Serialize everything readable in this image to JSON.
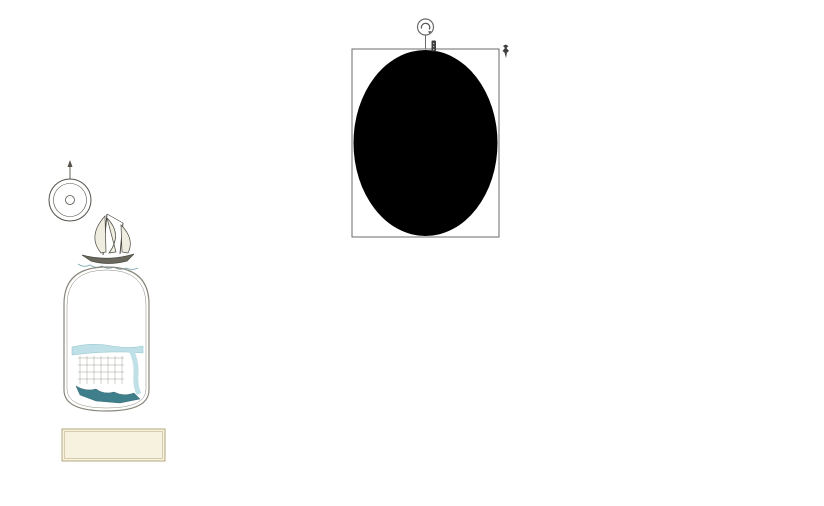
{
  "annotation": {
    "tool_name": "ellipse-highlight",
    "fill": "#2e6287",
    "opacity": 0.72,
    "bbox": {
      "x": 352,
      "y": 49,
      "w": 147,
      "h": 188
    },
    "ellipse": {
      "cx": 425.5,
      "cy": 143,
      "rx": 72,
      "ry": 93
    },
    "rotation_handle": {
      "cx": 425.5,
      "cy": 27,
      "r": 8
    },
    "handles": [
      "tl",
      "tc",
      "tr",
      "ml",
      "mr",
      "bl",
      "bc",
      "br"
    ]
  },
  "map": {
    "colors": {
      "paper": "#fffdf6",
      "water": "#cbe6ec",
      "water_line": "#8fc3cf",
      "sand": "#e8ddc0",
      "sand_line": "#c4b48c",
      "lot_yellow": "#efe48a",
      "lot_line": "#a49e6e",
      "lot_inner": "#fffef8",
      "tree": "#a4d463",
      "tree_line": "#6b9c39",
      "road_casing": "#908d80",
      "pink": "#dd7777",
      "pink_fill": "#fdeeee",
      "green_strip": "#a8d767",
      "green_strip_line": "#6fa03c",
      "pier": "#8f8a33",
      "label_dark": "#2f2f2f",
      "label_teal": "#23505c",
      "label_blue": "#39628c",
      "street_text": "#8b8578"
    },
    "labels": [
      {
        "text": "To the Atlantic Ocean",
        "x": 745,
        "y": 21,
        "fs": 11,
        "color": "#2f2f2f",
        "ls": 1
      },
      {
        "text": "Pretty  Lake",
        "x": 98,
        "y": 481,
        "fs": 11,
        "color": "#23505c",
        "ls": 3
      },
      {
        "text": "Pretty Lake Marinas",
        "x": 642,
        "y": 496,
        "fs": 11,
        "color": "#2f2f2f",
        "ls": 1
      },
      {
        "text": "Bay Front Green",
        "x": 738,
        "y": 78,
        "fs": 4.5,
        "color": "#2e5d2e",
        "rot": -90,
        "ls": 0
      }
    ],
    "street_labels": [
      {
        "text": "E A S T   B E A C H   D R I V E",
        "x": 322,
        "y": 87,
        "fs": 6
      },
      {
        "text": "E A S T   B E A C H   D R I V E",
        "x": 668,
        "y": 98,
        "fs": 5.5
      },
      {
        "text": "P L E A S A N T    A V E N U E",
        "x": 553,
        "y": 234,
        "fs": 6.5
      },
      {
        "text": "HAMMOCK  LANE",
        "x": 452,
        "y": 340,
        "fs": 5.5
      },
      {
        "text": "HAMMOCK  LANE",
        "x": 630,
        "y": 352,
        "fs": 5.5
      }
    ],
    "curved_labels": [
      {
        "path": "pth-shore",
        "text": "S H O R E   D R I V E",
        "fs": 6.5,
        "offset": "6%"
      },
      {
        "path": "pth-pla",
        "text": "P R E T T Y   L A K E   A V E N U E",
        "fs": 6.5,
        "offset": "8%"
      }
    ],
    "boxes": [
      {
        "x": 434,
        "y": 56,
        "w": 44,
        "h": 34,
        "stroke": "#dd6b6b",
        "sw": 1.5,
        "fill": "#fdf3f3",
        "lines": [
          "Bay Front",
          "Club Tower",
          "Pool, Fitness"
        ],
        "fs": 5,
        "tcolor": "#2c5d8a"
      },
      {
        "x": 578,
        "y": 210,
        "w": 46,
        "h": 26,
        "stroke": "#e06a6a",
        "sw": 2,
        "fill": "#ffffff",
        "lines": [
          "Fountain",
          "Park"
        ],
        "fs": 6,
        "tcolor": "#2f2f2f"
      },
      {
        "x": 583,
        "y": 303,
        "w": 44,
        "h": 40,
        "stroke": "#e06a6a",
        "sw": 2,
        "fill": "#ffffff",
        "lines": [
          "Tennis",
          "Courts"
        ],
        "fs": 5.5,
        "tcolor": "#2f2f2f"
      },
      {
        "x": 627,
        "y": 303,
        "w": 48,
        "h": 40,
        "stroke": "#e06a6a",
        "sw": 2,
        "fill": "#ffffff",
        "lines": [
          "Stage Pavilion",
          "Playground"
        ],
        "fs": 5.2,
        "tcolor": "#2f2f2f"
      },
      {
        "x": 586,
        "y": 366,
        "w": 40,
        "h": 28,
        "stroke": "#e06a6a",
        "sw": 2,
        "fill": "#ffffff",
        "lines": [
          "Garden",
          "Pergola"
        ],
        "fs": 5.5,
        "tcolor": "#2f2f2f"
      },
      {
        "x": 383,
        "y": 410,
        "w": 92,
        "h": 26,
        "stroke": "#e89b9b",
        "sw": 2,
        "fill": "#fffef4",
        "lines": [
          "East Beach Villas"
        ],
        "fs": 6.5,
        "tcolor": "#39628c"
      },
      {
        "x": 700,
        "y": 186,
        "w": 80,
        "h": 48,
        "stroke": "#97948a",
        "sw": 1,
        "fill": "#fffdf4",
        "inner": true,
        "lines": [
          "Pleasant",
          "Village",
          "Apartments"
        ],
        "fs": 5,
        "tcolor": "#39628c"
      }
    ],
    "green_strips": [
      {
        "x": 88,
        "y": 34,
        "w": 24,
        "h": 48
      },
      {
        "x": 141,
        "y": 38,
        "w": 11,
        "h": 44
      },
      {
        "x": 255,
        "y": 42,
        "w": 13,
        "h": 44
      },
      {
        "x": 413,
        "y": 58,
        "w": 15,
        "h": 36
      },
      {
        "x": 666,
        "y": 56,
        "w": 20,
        "h": 40
      },
      {
        "x": 729,
        "y": 56,
        "w": 18,
        "h": 40
      },
      {
        "x": 576,
        "y": 96,
        "w": 17,
        "h": 48
      }
    ],
    "top_columns": [
      {
        "x": 63,
        "y": 33,
        "w": 25,
        "h": 50,
        "rows": 7,
        "cols": 1
      },
      {
        "x": 112,
        "y": 33,
        "w": 25,
        "h": 50,
        "rows": 7,
        "cols": 1
      },
      {
        "x": 152,
        "y": 36,
        "w": 25,
        "h": 46,
        "rows": 7,
        "cols": 1
      },
      {
        "x": 196,
        "y": 46,
        "w": 52,
        "h": 42,
        "rows": 3,
        "cols": 2
      },
      {
        "x": 272,
        "y": 46,
        "w": 50,
        "h": 42,
        "rows": 3,
        "cols": 2
      },
      {
        "x": 326,
        "y": 48,
        "w": 48,
        "h": 40,
        "rows": 3,
        "cols": 2
      },
      {
        "x": 378,
        "y": 48,
        "w": 32,
        "h": 40,
        "rows": 3,
        "cols": 1
      },
      {
        "x": 482,
        "y": 52,
        "w": 46,
        "h": 44,
        "rows": 4,
        "cols": 2
      },
      {
        "x": 532,
        "y": 52,
        "w": 21,
        "h": 44,
        "rows": 4,
        "cols": 1
      },
      {
        "x": 556,
        "y": 52,
        "w": 21,
        "h": 44,
        "rows": 4,
        "cols": 1
      },
      {
        "x": 580,
        "y": 53,
        "w": 21,
        "h": 44,
        "rows": 4,
        "cols": 1
      },
      {
        "x": 604,
        "y": 53,
        "w": 21,
        "h": 44,
        "rows": 4,
        "cols": 1
      },
      {
        "x": 628,
        "y": 54,
        "w": 21,
        "h": 44,
        "rows": 4,
        "cols": 1
      },
      {
        "x": 644,
        "y": 54,
        "w": 18,
        "h": 42,
        "rows": 4,
        "cols": 1
      },
      {
        "x": 690,
        "y": 55,
        "w": 21,
        "h": 42,
        "rows": 4,
        "cols": 1
      },
      {
        "x": 712,
        "y": 55,
        "w": 15,
        "h": 42,
        "rows": 4,
        "cols": 1
      },
      {
        "x": 751,
        "y": 56,
        "w": 20,
        "h": 42,
        "rows": 4,
        "cols": 1
      },
      {
        "x": 774,
        "y": 56,
        "w": 20,
        "h": 42,
        "rows": 4,
        "cols": 1
      }
    ],
    "blocks": [
      {
        "x": 256,
        "y": 98,
        "w": 38,
        "h": 130,
        "rows": 9,
        "cols": 2
      },
      {
        "x": 304,
        "y": 98,
        "w": 37,
        "h": 130,
        "rows": 9,
        "cols": 2
      },
      {
        "x": 351,
        "y": 99,
        "w": 37,
        "h": 129,
        "rows": 9,
        "cols": 2
      },
      {
        "x": 398,
        "y": 99,
        "w": 37,
        "h": 129,
        "rows": 9,
        "cols": 2
      },
      {
        "x": 445,
        "y": 100,
        "w": 37,
        "h": 128,
        "rows": 9,
        "cols": 2
      },
      {
        "x": 492,
        "y": 100,
        "w": 38,
        "h": 128,
        "rows": 9,
        "cols": 2
      },
      {
        "x": 540,
        "y": 101,
        "w": 37,
        "h": 127,
        "rows": 9,
        "cols": 2
      },
      {
        "x": 587,
        "y": 101,
        "w": 38,
        "h": 103,
        "rows": 7,
        "cols": 2
      },
      {
        "x": 635,
        "y": 102,
        "w": 37,
        "h": 126,
        "rows": 9,
        "cols": 2
      },
      {
        "x": 682,
        "y": 103,
        "w": 38,
        "h": 80,
        "rows": 6,
        "cols": 2
      },
      {
        "x": 730,
        "y": 104,
        "w": 37,
        "h": 78,
        "rows": 6,
        "cols": 2
      },
      {
        "x": 777,
        "y": 105,
        "w": 30,
        "h": 122,
        "rows": 9,
        "cols": 2
      },
      {
        "x": 256,
        "y": 246,
        "w": 38,
        "h": 88,
        "rows": 6,
        "cols": 2
      },
      {
        "x": 304,
        "y": 246,
        "w": 37,
        "h": 88,
        "rows": 6,
        "cols": 2
      },
      {
        "x": 351,
        "y": 246,
        "w": 37,
        "h": 88,
        "rows": 6,
        "cols": 2
      },
      {
        "x": 398,
        "y": 246,
        "w": 37,
        "h": 88,
        "rows": 6,
        "cols": 2
      },
      {
        "x": 445,
        "y": 247,
        "w": 37,
        "h": 87,
        "rows": 6,
        "cols": 2
      },
      {
        "x": 492,
        "y": 247,
        "w": 38,
        "h": 87,
        "rows": 6,
        "cols": 2
      },
      {
        "x": 540,
        "y": 248,
        "w": 37,
        "h": 86,
        "rows": 6,
        "cols": 2
      },
      {
        "x": 587,
        "y": 248,
        "w": 38,
        "h": 50,
        "rows": 3,
        "cols": 2
      },
      {
        "x": 635,
        "y": 249,
        "w": 37,
        "h": 85,
        "rows": 6,
        "cols": 2
      },
      {
        "x": 682,
        "y": 250,
        "w": 38,
        "h": 86,
        "rows": 6,
        "cols": 2
      },
      {
        "x": 730,
        "y": 251,
        "w": 37,
        "h": 86,
        "rows": 6,
        "cols": 2
      },
      {
        "x": 777,
        "y": 252,
        "w": 30,
        "h": 86,
        "rows": 6,
        "cols": 2
      },
      {
        "x": 256,
        "y": 352,
        "w": 38,
        "h": 60,
        "rows": 4,
        "cols": 2
      },
      {
        "x": 304,
        "y": 352,
        "w": 37,
        "h": 60,
        "rows": 4,
        "cols": 2
      },
      {
        "x": 351,
        "y": 352,
        "w": 37,
        "h": 52,
        "rows": 4,
        "cols": 2
      },
      {
        "x": 398,
        "y": 352,
        "w": 37,
        "h": 52,
        "rows": 4,
        "cols": 2
      },
      {
        "x": 445,
        "y": 353,
        "w": 37,
        "h": 52,
        "rows": 4,
        "cols": 2
      },
      {
        "x": 492,
        "y": 353,
        "w": 38,
        "h": 68,
        "rows": 5,
        "cols": 2
      },
      {
        "x": 540,
        "y": 354,
        "w": 37,
        "h": 66,
        "rows": 5,
        "cols": 2
      },
      {
        "x": 587,
        "y": 354,
        "w": 38,
        "h": 62,
        "rows": 4,
        "cols": 2
      },
      {
        "x": 635,
        "y": 360,
        "w": 37,
        "h": 58,
        "rows": 4,
        "cols": 2
      },
      {
        "x": 682,
        "y": 360,
        "w": 38,
        "h": 58,
        "rows": 4,
        "cols": 2
      },
      {
        "x": 730,
        "y": 362,
        "w": 37,
        "h": 56,
        "rows": 4,
        "cols": 2
      },
      {
        "x": 777,
        "y": 362,
        "w": 30,
        "h": 56,
        "rows": 4,
        "cols": 2
      },
      {
        "x": 587,
        "y": 422,
        "w": 38,
        "h": 34,
        "rows": 2,
        "cols": 2
      },
      {
        "x": 635,
        "y": 424,
        "w": 37,
        "h": 32,
        "rows": 2,
        "cols": 2
      },
      {
        "x": 682,
        "y": 426,
        "w": 38,
        "h": 32,
        "rows": 2,
        "cols": 2
      },
      {
        "x": 730,
        "y": 428,
        "w": 37,
        "h": 30,
        "rows": 2,
        "cols": 2
      },
      {
        "x": 777,
        "y": 428,
        "w": 30,
        "h": 28,
        "rows": 2,
        "cols": 2
      }
    ],
    "buildings": [
      {
        "x": 204,
        "y": 266,
        "w": 36,
        "h": 18,
        "r": -3
      },
      {
        "x": 248,
        "y": 262,
        "w": 28,
        "h": 14,
        "r": -2
      },
      {
        "x": 206,
        "y": 312,
        "w": 30,
        "h": 22,
        "r": -2
      },
      {
        "x": 244,
        "y": 310,
        "w": 24,
        "h": 16,
        "r": 0
      },
      {
        "x": 298,
        "y": 308,
        "w": 26,
        "h": 14,
        "r": 0
      },
      {
        "x": 212,
        "y": 360,
        "w": 30,
        "h": 16,
        "r": 0
      },
      {
        "x": 252,
        "y": 358,
        "w": 22,
        "h": 12,
        "r": 0
      },
      {
        "x": 286,
        "y": 356,
        "w": 30,
        "h": 14,
        "r": 0
      },
      {
        "x": 224,
        "y": 404,
        "w": 40,
        "h": 14,
        "r": 2
      },
      {
        "x": 282,
        "y": 402,
        "w": 26,
        "h": 12,
        "r": 1
      },
      {
        "x": 112,
        "y": 96,
        "w": 12,
        "h": 36,
        "r": 0
      }
    ],
    "streets_v": [
      {
        "x": 232,
        "y1": 90,
        "y2": 422
      },
      {
        "x": 252,
        "y1": 90,
        "y2": 424
      },
      {
        "x": 300,
        "y1": 90,
        "y2": 428
      },
      {
        "x": 347,
        "y1": 91,
        "y2": 430
      },
      {
        "x": 394,
        "y1": 91,
        "y2": 434
      },
      {
        "x": 441,
        "y1": 92,
        "y2": 438
      },
      {
        "x": 488,
        "y1": 93,
        "y2": 442
      },
      {
        "x": 536,
        "y1": 94,
        "y2": 446
      },
      {
        "x": 583,
        "y1": 95,
        "y2": 450
      },
      {
        "x": 631,
        "y1": 96,
        "y2": 452
      },
      {
        "x": 678,
        "y1": 97,
        "y2": 456
      },
      {
        "x": 726,
        "y1": 98,
        "y2": 460
      },
      {
        "x": 773,
        "y1": 99,
        "y2": 462
      }
    ],
    "tree_rows": [
      {
        "x": 252,
        "y": 104,
        "dx": 0,
        "dy": 27,
        "n": 12
      },
      {
        "x": 300,
        "y": 104,
        "dx": 0,
        "dy": 27,
        "n": 12
      },
      {
        "x": 347,
        "y": 106,
        "dx": 0,
        "dy": 27,
        "n": 12
      },
      {
        "x": 394,
        "y": 106,
        "dx": 0,
        "dy": 27,
        "n": 12
      },
      {
        "x": 441,
        "y": 106,
        "dx": 0,
        "dy": 27,
        "n": 12
      },
      {
        "x": 488,
        "y": 108,
        "dx": 0,
        "dy": 27,
        "n": 12
      },
      {
        "x": 536,
        "y": 108,
        "dx": 0,
        "dy": 27,
        "n": 12
      },
      {
        "x": 583,
        "y": 108,
        "dx": 0,
        "dy": 27,
        "n": 12
      },
      {
        "x": 631,
        "y": 110,
        "dx": 0,
        "dy": 27,
        "n": 12
      },
      {
        "x": 678,
        "y": 110,
        "dx": 0,
        "dy": 27,
        "n": 12
      },
      {
        "x": 726,
        "y": 112,
        "dx": 0,
        "dy": 27,
        "n": 12
      },
      {
        "x": 773,
        "y": 112,
        "dx": 0,
        "dy": 27,
        "n": 12
      },
      {
        "x": 262,
        "y": 244,
        "dx": 31,
        "dy": 0,
        "n": 17
      },
      {
        "x": 348,
        "y": 351,
        "dx": 31,
        "dy": 0.3,
        "n": 16
      },
      {
        "x": 246,
        "y": 430,
        "dx": 31,
        "dy": 1.2,
        "n": 11
      },
      {
        "x": 584,
        "y": 452,
        "dx": 30,
        "dy": 1.4,
        "n": 8
      },
      {
        "x": 242,
        "y": 97,
        "dx": 33,
        "dy": 0.35,
        "n": 18
      },
      {
        "x": 150,
        "y": 128,
        "dx": 13,
        "dy": 37,
        "n": 5
      },
      {
        "x": 208,
        "y": 318,
        "dx": 6,
        "dy": 36,
        "n": 3
      },
      {
        "x": 206,
        "y": 240,
        "dx": 44,
        "dy": 0,
        "n": 4
      },
      {
        "x": 210,
        "y": 420,
        "dx": 40,
        "dy": 1,
        "n": 4
      },
      {
        "x": 371,
        "y": 118,
        "dx": 2,
        "dy": 24,
        "n": 4
      },
      {
        "x": 433,
        "y": 146,
        "dx": 8,
        "dy": 22,
        "n": 3
      },
      {
        "x": 54,
        "y": 94,
        "dx": 58,
        "dy": -2,
        "n": 2
      },
      {
        "x": 64,
        "y": 138,
        "dx": 50,
        "dy": -2,
        "n": 2
      }
    ],
    "logo": {
      "title1": "EAST",
      "title2": "BEACH",
      "subtitle": "Norfolk , Virginia",
      "inset_bay": "Chesapeake Bay",
      "inset_creek": "Little Creek",
      "est": "est. 2003",
      "website": "www.EastBeachNorfolk.com",
      "phone": "757-333-6850",
      "compass": {
        "n": "N",
        "e": "E",
        "s": "S",
        "w": "W"
      }
    }
  }
}
